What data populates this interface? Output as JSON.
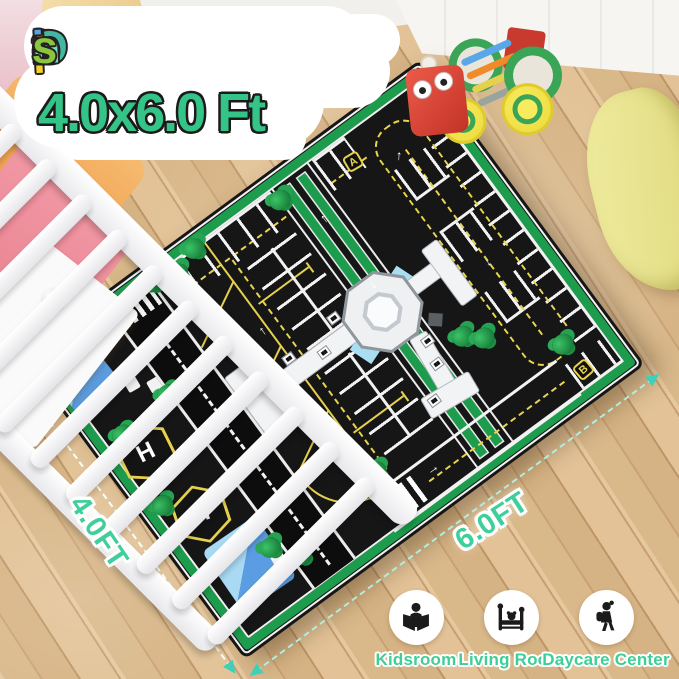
{
  "product_overlay": {
    "size_options_title": {
      "text": "3 Size Options",
      "letter_colors": [
        "#efcf9e",
        "#7fc043",
        "#f6d322",
        "#3f8ed2",
        "#f2d022",
        "#43b7a2",
        "#f6cf27",
        "#ef7f28",
        "#5aa0e2",
        "#f2cfa2",
        "#7bdec2",
        "#8cc63e"
      ]
    },
    "size_label": "4.0x6.0 Ft",
    "width_label": "4.0FT",
    "length_label": "6.0FT"
  },
  "mat": {
    "theme": "airport-parking-lot-playmat",
    "marker_a": "A",
    "marker_b": "B",
    "helipad_letter": "H",
    "colors": {
      "mat_black": "#161616",
      "border_green": "#1c9c4c",
      "marking_yellow": "#e6d14f",
      "marking_white": "#f2f2f2",
      "water_blue": "#5b9de2",
      "measure_teal": "#3fd0b9"
    }
  },
  "usage_locations": [
    {
      "label": "Kidsroom",
      "icon": "child-reading-icon"
    },
    {
      "label": "Living Room",
      "icon": "toddler-bed-icon"
    },
    {
      "label": "Daycare Center",
      "icon": "child-with-backpack-icon"
    }
  ],
  "overlay_colors": {
    "title_green": "#35c487",
    "dim_label_green": "#3ecf9a"
  }
}
